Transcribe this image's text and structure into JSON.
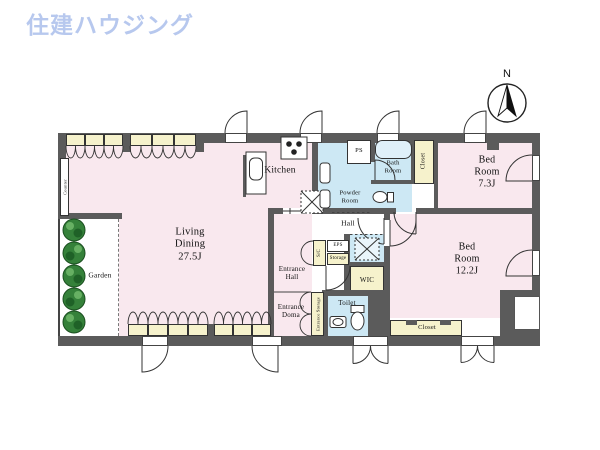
{
  "brand": {
    "logo_text": "住建ハウジング"
  },
  "compass": {
    "north_label": "N"
  },
  "colors": {
    "room_pink": "#f9e8ee",
    "water_blue": "#cde8f4",
    "closet_cream": "#f6f2cc",
    "wall_gray": "#5b5b5b",
    "logo_blue": "#b7c8ee",
    "tree_green": "#35813a"
  },
  "rooms": {
    "living": {
      "label": "Living\nDining\n27.5J"
    },
    "kitchen": {
      "label": "Kitchen"
    },
    "ps": {
      "label": "PS"
    },
    "bath": {
      "label": "Bath\nRoom"
    },
    "closet_north": {
      "label": "Closet"
    },
    "bed1": {
      "label": "Bed\nRoom\n7.3J"
    },
    "powder": {
      "label": "Powder\nRoom"
    },
    "hall": {
      "label": "Hall"
    },
    "sc": {
      "label": "S/C"
    },
    "eps": {
      "label": "EPS"
    },
    "storage": {
      "label": "Storage"
    },
    "entrance_hall": {
      "label": "Entrance\nHall"
    },
    "entrance_doma": {
      "label": "Entrance\nDoma"
    },
    "entrance_storage": {
      "label": "Entrance Storage"
    },
    "toilet": {
      "label": "Toilet"
    },
    "wic": {
      "label": "WIC"
    },
    "bed2": {
      "label": "Bed\nRoom\n12.2J"
    },
    "closet_south": {
      "label": "Closet"
    },
    "garden": {
      "label": "Garden"
    },
    "counter": {
      "label": "Counter"
    }
  }
}
